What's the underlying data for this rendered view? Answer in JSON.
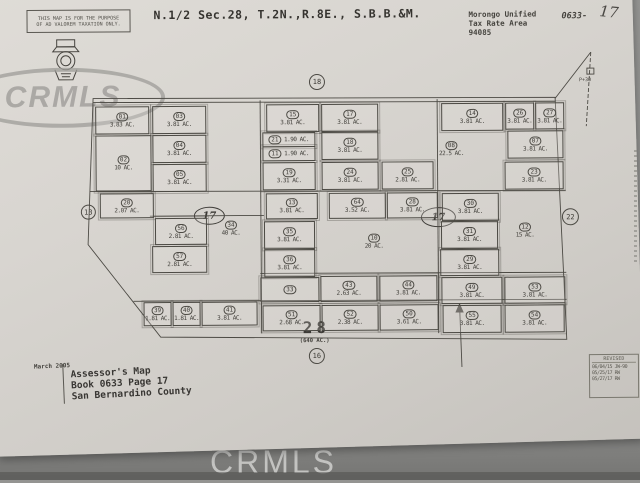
{
  "watermark": {
    "text": "CRMLS"
  },
  "header": {
    "stamp_line1": "THIS MAP IS FOR THE PURPOSE",
    "stamp_line2": "OF AD VALOREM TAXATION ONLY.",
    "title": "N.1/2 Sec.28, T.2N.,R.8E., S.B.B.&M.",
    "tax_area": "Morongo Unified\nTax Rate Area\n94085",
    "book_page_printed": "0633-",
    "book_page_handwritten": "17"
  },
  "map": {
    "section_number": "28",
    "section_acreage": "(640 AC.)",
    "adjacent_refs": {
      "top": "18",
      "left": "13",
      "right": "22",
      "bottom": "16"
    },
    "oval_left": "17",
    "oval_right": "17",
    "road_label": "P+30",
    "parcels": [
      {
        "id": "01",
        "ac": "3.83 AC.",
        "x": 96,
        "y": 105,
        "w": 52,
        "h": 26
      },
      {
        "id": "03",
        "ac": "3.81 AC.",
        "x": 153,
        "y": 105,
        "w": 52,
        "h": 26
      },
      {
        "id": "02",
        "ac": "10 AC.",
        "x": 96,
        "y": 134,
        "w": 54,
        "h": 54
      },
      {
        "id": "04",
        "ac": "3.81 AC.",
        "x": 153,
        "y": 134,
        "w": 52,
        "h": 26
      },
      {
        "id": "05",
        "ac": "3.81 AC.",
        "x": 153,
        "y": 163,
        "w": 52,
        "h": 26
      },
      {
        "id": "20",
        "ac": "2.07 AC.",
        "x": 100,
        "y": 192,
        "w": 52,
        "h": 23
      },
      {
        "id": "56",
        "ac": "2.81 AC.",
        "x": 155,
        "y": 217,
        "w": 50,
        "h": 25
      },
      {
        "id": "57",
        "ac": "2.81 AC.",
        "x": 152,
        "y": 245,
        "w": 53,
        "h": 25
      },
      {
        "id": "34",
        "ac": "40 AC.",
        "x": 210,
        "y": 218,
        "w": 42,
        "h": 20,
        "box": false
      },
      {
        "id": "15",
        "ac": "3.81 AC.",
        "x": 267,
        "y": 104,
        "w": 51,
        "h": 26
      },
      {
        "id": "17",
        "ac": "3.81 AC.",
        "x": 322,
        "y": 104,
        "w": 55,
        "h": 26
      },
      {
        "id": "21",
        "ac": "1.90 AC.",
        "x": 263,
        "y": 132,
        "w": 51,
        "h": 13
      },
      {
        "id": "11",
        "ac": "1.90 AC.",
        "x": 263,
        "y": 146,
        "w": 51,
        "h": 13
      },
      {
        "id": "18",
        "ac": "3.81 AC.",
        "x": 322,
        "y": 132,
        "w": 55,
        "h": 26
      },
      {
        "id": "19",
        "ac": "3.31 AC.",
        "x": 263,
        "y": 162,
        "w": 51,
        "h": 26
      },
      {
        "id": "24",
        "ac": "3.81 AC.",
        "x": 322,
        "y": 162,
        "w": 55,
        "h": 26
      },
      {
        "id": "25",
        "ac": "2.81 AC.",
        "x": 382,
        "y": 162,
        "w": 50,
        "h": 26
      },
      {
        "id": "13",
        "ac": "3.81 AC.",
        "x": 266,
        "y": 193,
        "w": 50,
        "h": 24
      },
      {
        "id": "64",
        "ac": "3.52 AC.",
        "x": 329,
        "y": 193,
        "w": 55,
        "h": 24
      },
      {
        "id": "28",
        "ac": "3.81 AC.",
        "x": 387,
        "y": 193,
        "w": 49,
        "h": 24
      },
      {
        "id": "35",
        "ac": "3.81 AC.",
        "x": 264,
        "y": 221,
        "w": 49,
        "h": 26
      },
      {
        "id": "36",
        "ac": "3.81 AC.",
        "x": 264,
        "y": 249,
        "w": 49,
        "h": 26
      },
      {
        "id": "10",
        "ac": "20 AC.",
        "x": 352,
        "y": 232,
        "w": 44,
        "h": 20,
        "box": false
      },
      {
        "id": "33",
        "ac": "",
        "x": 260,
        "y": 277,
        "w": 57,
        "h": 23
      },
      {
        "id": "43",
        "ac": "2.63 AC.",
        "x": 320,
        "y": 276,
        "w": 55,
        "h": 24
      },
      {
        "id": "44",
        "ac": "3.81 AC.",
        "x": 379,
        "y": 276,
        "w": 56,
        "h": 24
      },
      {
        "id": "51",
        "ac": "2.68 AC.",
        "x": 262,
        "y": 305,
        "w": 56,
        "h": 24
      },
      {
        "id": "52",
        "ac": "2.38 AC.",
        "x": 321,
        "y": 305,
        "w": 55,
        "h": 24
      },
      {
        "id": "50",
        "ac": "3.61 AC.",
        "x": 379,
        "y": 305,
        "w": 57,
        "h": 24
      },
      {
        "id": "39",
        "ac": "1.81 AC.",
        "x": 143,
        "y": 301,
        "w": 26,
        "h": 22
      },
      {
        "id": "40",
        "ac": "1.81 AC.",
        "x": 172,
        "y": 301,
        "w": 26,
        "h": 22
      },
      {
        "id": "41",
        "ac": "3.81 AC.",
        "x": 201,
        "y": 301,
        "w": 54,
        "h": 22
      },
      {
        "id": "14",
        "ac": "3.81 AC.",
        "x": 442,
        "y": 104,
        "w": 60,
        "h": 26
      },
      {
        "id": "26",
        "ac": "3.81 AC.",
        "x": 506,
        "y": 104,
        "w": 27,
        "h": 25
      },
      {
        "id": "27",
        "ac": "3.81 AC.",
        "x": 536,
        "y": 104,
        "w": 27,
        "h": 25
      },
      {
        "id": "08",
        "ac": "22.5 AC.",
        "x": 430,
        "y": 140,
        "w": 44,
        "h": 20,
        "box": false
      },
      {
        "id": "07",
        "ac": "3.81 AC.",
        "x": 508,
        "y": 132,
        "w": 54,
        "h": 26
      },
      {
        "id": "23",
        "ac": "3.81 AC.",
        "x": 505,
        "y": 163,
        "w": 57,
        "h": 26
      },
      {
        "id": "30",
        "ac": "3.81 AC.",
        "x": 442,
        "y": 194,
        "w": 55,
        "h": 26
      },
      {
        "id": "31",
        "ac": "3.81 AC.",
        "x": 441,
        "y": 222,
        "w": 55,
        "h": 26
      },
      {
        "id": "29",
        "ac": "3.81 AC.",
        "x": 440,
        "y": 250,
        "w": 57,
        "h": 25
      },
      {
        "id": "12",
        "ac": "15 AC.",
        "x": 503,
        "y": 222,
        "w": 44,
        "h": 20,
        "box": false
      },
      {
        "id": "49",
        "ac": "3.81 AC.",
        "x": 441,
        "y": 278,
        "w": 59,
        "h": 25
      },
      {
        "id": "53",
        "ac": "3.81 AC.",
        "x": 504,
        "y": 278,
        "w": 59,
        "h": 25
      },
      {
        "id": "55",
        "ac": "3.81 AC.",
        "x": 442,
        "y": 306,
        "w": 57,
        "h": 26
      },
      {
        "id": "54",
        "ac": "3.81 AC.",
        "x": 504,
        "y": 306,
        "w": 58,
        "h": 26
      }
    ]
  },
  "footer": {
    "date": "March 2005",
    "attribution": "Assessor's Map\nBook 0633 Page 17\nSan Bernardino County",
    "revision": {
      "header": "REVISED",
      "rows": [
        "06/04/15 JW-90",
        "05/25/17 RW",
        "05/27/17 RW"
      ]
    }
  }
}
